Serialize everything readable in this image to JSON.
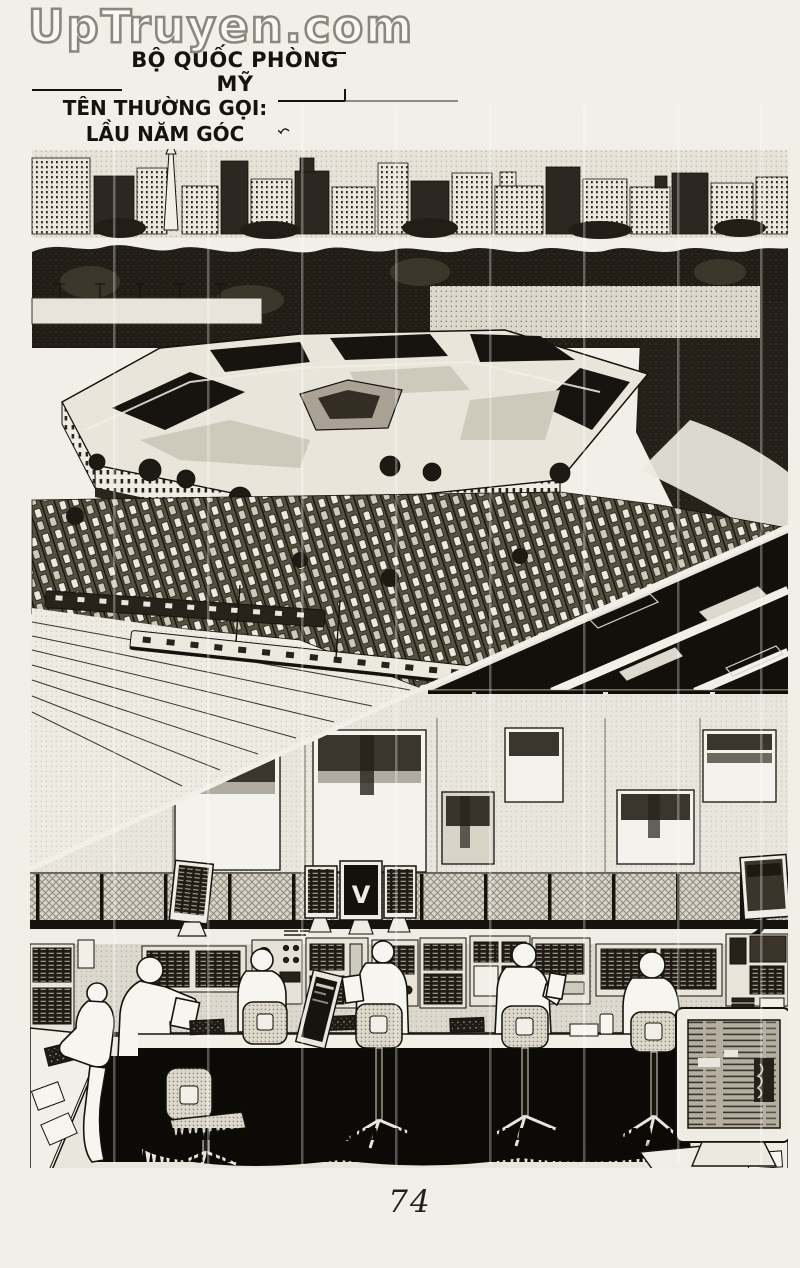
{
  "watermark": {
    "text": "UpTruyen.com"
  },
  "captions": {
    "defense_ministry": "BỘ QUỐC PHÒNG MỸ",
    "common_name_label": "TÊN THƯỜNG GỌI:",
    "common_name_value": "LẦU NĂM GÓC"
  },
  "art": {
    "center_monitor_glyph": "V"
  },
  "footer": {
    "page_number": "74"
  },
  "colors": {
    "paper": "#f2efe9",
    "ink": "#16130e",
    "halftone": "#b9b3a7"
  }
}
